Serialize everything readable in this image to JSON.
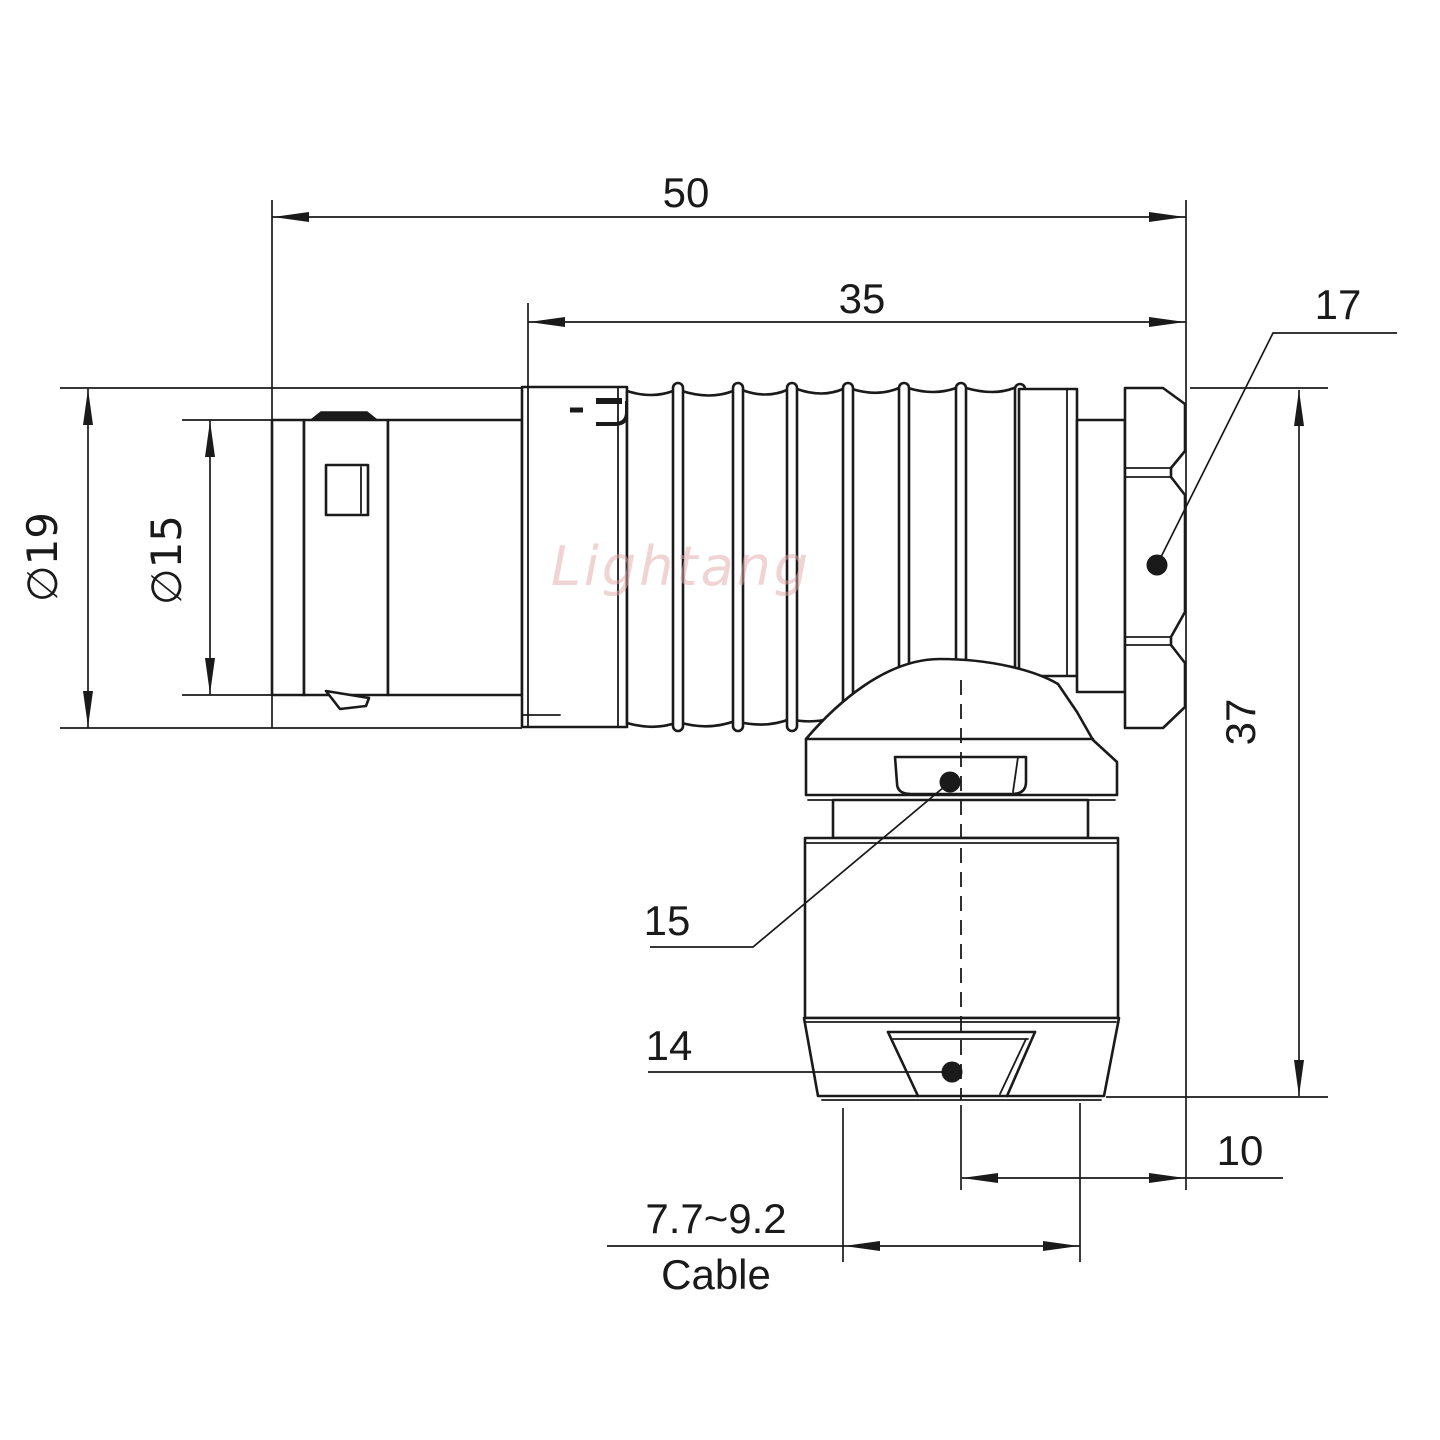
{
  "drawing": {
    "title": "right-angle circular connector technical drawing",
    "dimensions": {
      "overall_length": "50",
      "rear_body_length": "35",
      "hex_nut_size": "17",
      "outer_diameter": "∅19",
      "inner_diameter": "∅15",
      "overall_height": "37",
      "gland_collar_ref": "15",
      "clamp_cone_ref": "14",
      "axis_to_end_offset": "10",
      "cable_diameter_range": "7.7~9.2",
      "cable_caption": "Cable"
    },
    "watermark": "Lightang",
    "colors": {
      "line": "#1a1a1a",
      "watermark_pink": "#e2a9a9",
      "background": "#ffffff"
    }
  }
}
